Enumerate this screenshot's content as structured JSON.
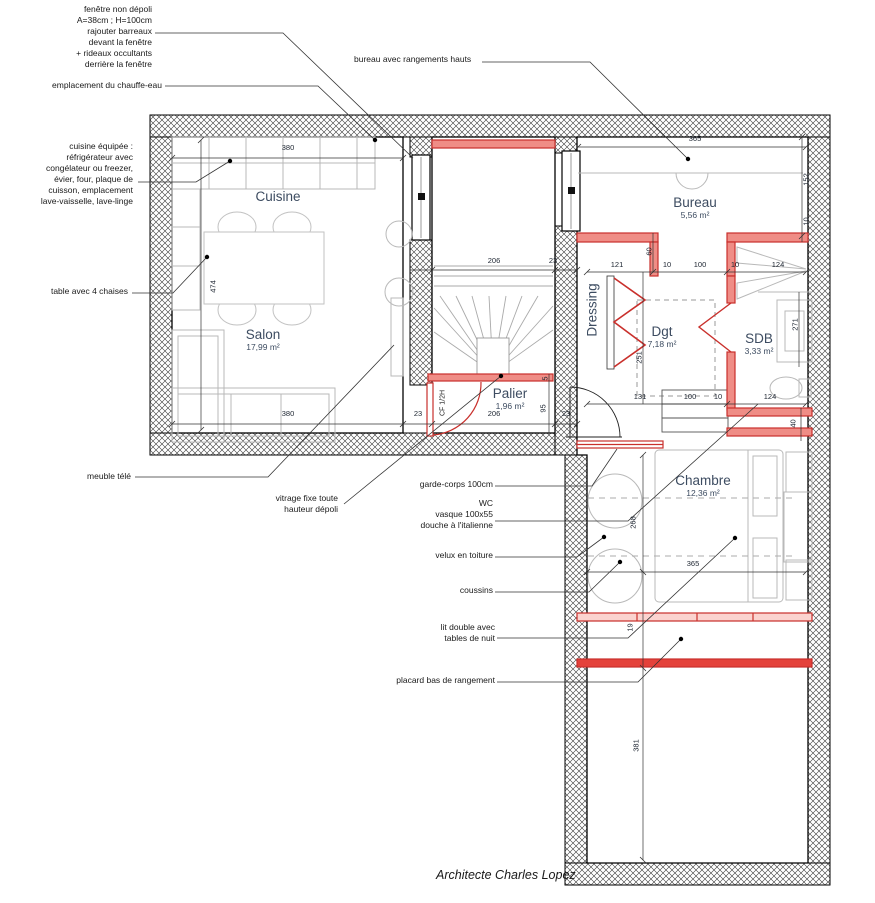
{
  "footer": {
    "credit": "Architecte Charles Lopez"
  },
  "colors": {
    "new_work_red": "#c9302c",
    "new_work_fill": "#ef8d86",
    "wall_hatch": "#333333",
    "room_label": "#3d4c61",
    "furniture_gray": "#b9b9b9"
  },
  "annotations": [
    {
      "id": "window-note",
      "lines": [
        "fenêtre non dépoli",
        "A=38cm ; H=100cm",
        "rajouter barreaux",
        "devant la fenêtre",
        "+ rideaux occultants",
        "derrière la fenêtre"
      ]
    },
    {
      "id": "water-heater",
      "lines": [
        "emplacement du chauffe-eau"
      ]
    },
    {
      "id": "kitchen-equipment",
      "lines": [
        "cuisine équipée :",
        "réfrigérateur avec",
        "congélateur ou freezer,",
        "évier, four, plaque de",
        "cuisson, emplacement",
        "lave-vaisselle, lave-linge"
      ]
    },
    {
      "id": "table-chairs",
      "lines": [
        "table avec 4 chaises"
      ]
    },
    {
      "id": "tv-cabinet",
      "lines": [
        "meuble télé"
      ]
    },
    {
      "id": "fixed-glazing",
      "lines": [
        "vitrage fixe toute",
        "hauteur dépoli"
      ]
    },
    {
      "id": "desk-storage",
      "lines": [
        "bureau avec rangements hauts"
      ]
    },
    {
      "id": "guardrail",
      "lines": [
        "garde-corps 100cm"
      ]
    },
    {
      "id": "bathroom-fittings",
      "lines": [
        "WC",
        "vasque 100x55",
        "douche à l'italienne"
      ]
    },
    {
      "id": "roof-window",
      "lines": [
        "velux en toiture"
      ]
    },
    {
      "id": "cushions",
      "lines": [
        "coussins"
      ]
    },
    {
      "id": "double-bed",
      "lines": [
        "lit double avec",
        "tables de nuit"
      ]
    },
    {
      "id": "low-storage",
      "lines": [
        "placard bas de rangement"
      ]
    }
  ],
  "rooms": [
    {
      "name": "Cuisine",
      "area": ""
    },
    {
      "name": "Salon",
      "area": "17,99 m²"
    },
    {
      "name": "Bureau",
      "area": "5,56 m²"
    },
    {
      "name": "Dressing",
      "area": ""
    },
    {
      "name": "Dgt",
      "area": "7,18 m²"
    },
    {
      "name": "SDB",
      "area": "3,33 m²"
    },
    {
      "name": "Palier",
      "area": "1,96 m²"
    },
    {
      "name": "Chambre",
      "area": "12,36 m²"
    }
  ],
  "labels": {
    "cf_door": "CF 1/2H"
  },
  "dims": [
    {
      "v": "380"
    },
    {
      "v": "206"
    },
    {
      "v": "23"
    },
    {
      "v": "365"
    },
    {
      "v": "121"
    },
    {
      "v": "10"
    },
    {
      "v": "100"
    },
    {
      "v": "10"
    },
    {
      "v": "124"
    },
    {
      "v": "131"
    },
    {
      "v": "100"
    },
    {
      "v": "10"
    },
    {
      "v": "124"
    },
    {
      "v": "380"
    },
    {
      "v": "23"
    },
    {
      "v": "206"
    },
    {
      "v": "23"
    },
    {
      "v": "365"
    },
    {
      "v": "474"
    },
    {
      "v": "152"
    },
    {
      "v": "10"
    },
    {
      "v": "60"
    },
    {
      "v": "251"
    },
    {
      "v": "271"
    },
    {
      "v": "40"
    },
    {
      "v": "5"
    },
    {
      "v": "95"
    },
    {
      "v": "268"
    },
    {
      "v": "19"
    },
    {
      "v": "381"
    }
  ]
}
